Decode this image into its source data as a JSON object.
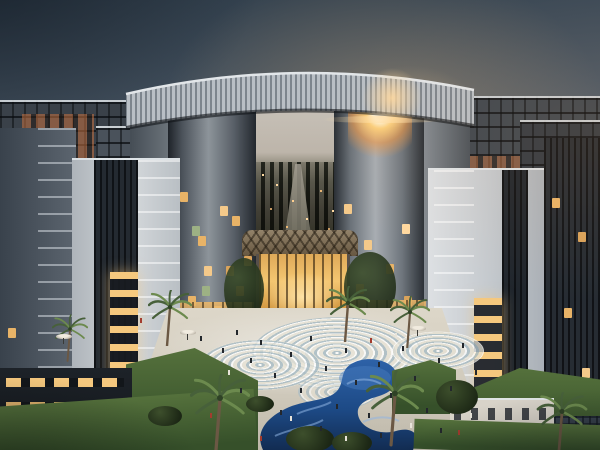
{
  "scene": {
    "description": "Dusk architectural rendering: an iconic oval arch skyscraper with a louvered crown ring frames the horizon; mid-rise apartment towers with lit balconies flank a palm-lined plaza with swirling mosaic paving, a winding blue pool and a glowing golden atrium entrance.",
    "time_of_day": "dusk",
    "palm_count": 7,
    "umbrella_count": 3
  },
  "colors": {
    "sky-top": "#2f3d4a",
    "sky-mid": "#53606e",
    "sky-horizon": "#8d99a4",
    "sun-glow": "#ffd79a",
    "crown": "#b9bfc5",
    "crown-stripe": "#7d858d",
    "crown-edge": "#e2e6e9",
    "city-sky": "#c7c1b8",
    "facade-light": "#c6cbd1",
    "facade-white": "#dfe1e3",
    "facade-dark": "#2c3239",
    "window-lit": "#f5c87e",
    "plaza-light": "#ddd7c9",
    "swirl-blue": "#a9bcc4",
    "pool-deep": "#173a6b",
    "pool-mid": "#2e62a8",
    "pool-wave": "#8fb4e2",
    "grass": "#55713c",
    "grass-dark": "#36502a",
    "foliage": "#3d4f2c",
    "palm-frond": "#47603a",
    "palm-frond-light": "#6c8a4e",
    "palm-trunk": "#6b5844",
    "person-dark": "#23272c",
    "person-light": "#e8e4da",
    "person-red": "#a33c2e"
  }
}
